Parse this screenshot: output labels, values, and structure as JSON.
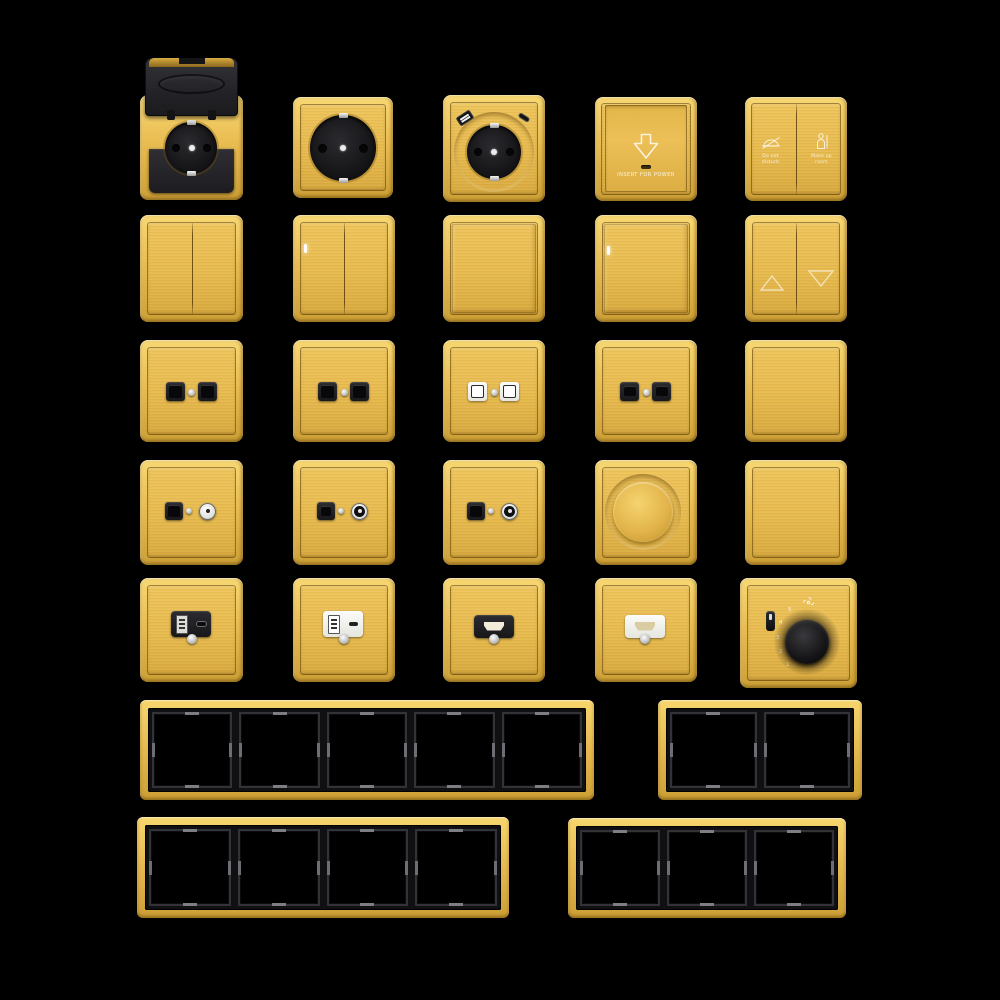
{
  "page": {
    "background": "#000000",
    "description": "Brushed gold wall switch, socket and frame collection on black"
  },
  "colors": {
    "gold_light": "#f8d873",
    "gold_mid": "#e7ba4e",
    "gold_dark": "#cda036",
    "module_black": "#1c1c1f",
    "module_white": "#f2f2ef",
    "indicator_white": "#ffffff",
    "background": "#000000"
  },
  "items": {
    "key_card_switch": {
      "label": "INSERT FOR POWER",
      "icon": "arrow-down"
    },
    "hotel_service_switch": {
      "left": {
        "icon": "do-not-disturb",
        "lines": [
          "Do not",
          "disturb"
        ]
      },
      "right": {
        "icon": "make-up-room",
        "lines": [
          "Make up",
          "room"
        ]
      }
    },
    "curtain_switch": {
      "icons": [
        "triangle-up",
        "triangle-down"
      ]
    },
    "thermostat": {
      "ticks": [
        "1",
        "2",
        "3",
        "4",
        "5"
      ],
      "icon": "fan"
    }
  },
  "catalog": {
    "row1": [
      "waterproof-socket-with-lid",
      "schuko-socket",
      "schuko-socket-usb",
      "key-card-switch",
      "hotel-service-switch"
    ],
    "row2": [
      "double-rocker-switch",
      "double-rocker-switch-led",
      "single-rocker-switch",
      "single-rocker-switch-led",
      "curtain-switch"
    ],
    "row3": [
      "dual-data-socket-black",
      "dual-data-socket-black",
      "dual-data-socket-white",
      "dual-phone-socket-black",
      "blank-plate"
    ],
    "row4": [
      "tv-data-socket",
      "tv-sat-socket",
      "tv-sat-socket",
      "rotary-dimmer",
      "blank-plate"
    ],
    "row5": [
      "usb-charger-black",
      "usb-charger-white",
      "hdmi-socket-black",
      "hdmi-socket-white",
      "fan-coil-thermostat"
    ],
    "row6": [
      "frame-5-gang",
      "frame-2-gang"
    ],
    "row7": [
      "frame-4-gang",
      "frame-3-gang"
    ]
  },
  "frames": {
    "five_gang": 5,
    "two_gang": 2,
    "four_gang": 4,
    "three_gang": 3
  }
}
